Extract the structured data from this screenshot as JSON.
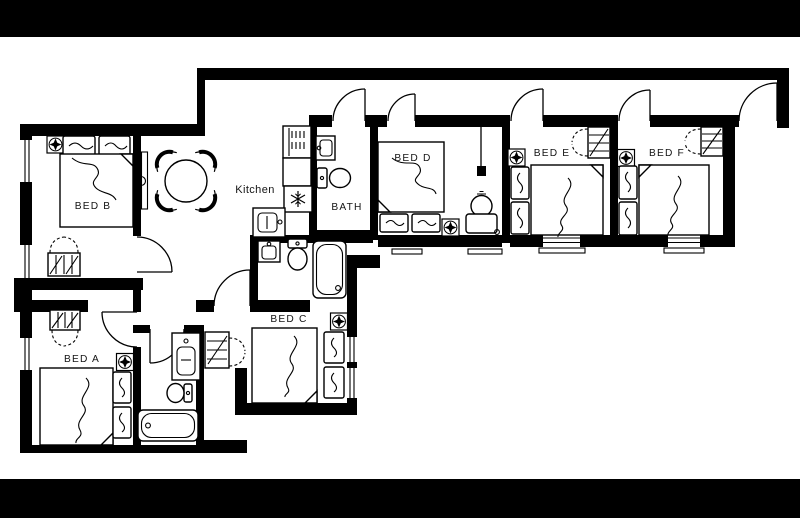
{
  "image": {
    "kind": "apartment floor plan drawing",
    "colors": {
      "ink": "#000000",
      "paper": "#ffffff",
      "border_bars": "#000000"
    }
  },
  "floorplan": {
    "labels": {
      "bed_a": "BED A",
      "bed_b": "BED B",
      "bed_c": "BED C",
      "bed_d": "BED D",
      "bed_e": "BED E",
      "bed_f": "BED F",
      "kitchen": "Kitchen",
      "bath": "BATH"
    },
    "rooms": [
      {
        "id": "bed-b",
        "label": "BED B"
      },
      {
        "id": "bed-a",
        "label": "BED A"
      },
      {
        "id": "bed-c",
        "label": "BED C"
      },
      {
        "id": "bed-d",
        "label": "BED D"
      },
      {
        "id": "bed-e",
        "label": "BED E"
      },
      {
        "id": "bed-f",
        "label": "BED F"
      },
      {
        "id": "kitchen",
        "label": "Kitchen"
      },
      {
        "id": "bath",
        "label": "BATH"
      }
    ]
  }
}
